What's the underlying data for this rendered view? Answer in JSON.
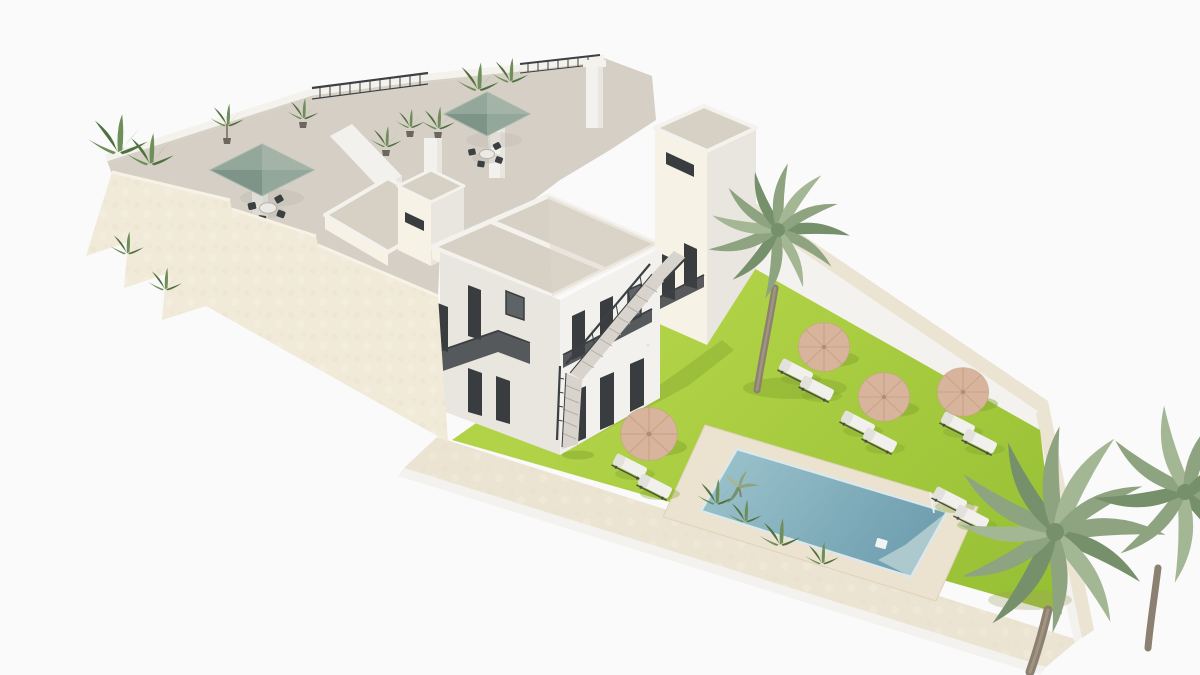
{
  "meta": {
    "kind": "3D architectural exterior render",
    "view": "aerial isometric view on a plain white backdrop",
    "subject": "White Mediterranean-style apartment building with stepped rooftop terraces, exterior staircases, and a walled garden with lawn, rectangular swimming pool, parasols, sun loungers and palm trees"
  },
  "colors": {
    "background": "#fafafa",
    "wall_cream": "#f1ead9",
    "wall_cream_shade": "#e7ddc7",
    "wall_cream_top": "#f7f2e6",
    "facade_white": "#f2f1ed",
    "facade_shade": "#e9e6e0",
    "facade_dark": "#dedad3",
    "roof_tan": "#d7d0c5",
    "terrace_floor": "#d5cfc5",
    "parapet_white": "#f4f2ec",
    "parapet_edge": "#d9d2c4",
    "railing_dark": "#3c4043",
    "window_dark": "#3a3d3f",
    "window_glass": "#5d6366",
    "umbrella_sage": "#93a79a",
    "umbrella_sage_shade": "#7e9488",
    "umbrella_sage_light": "#a3b3a5",
    "lawn_light": "#b2d348",
    "lawn_deep": "#96bf33",
    "shadow_green": "#7fa32c",
    "pool_deck": "#ebe2cf",
    "pool_water_light": "#98c0ca",
    "pool_water_deep": "#6d9dae",
    "pool_steps": "#b7d0d4",
    "pool_rim": "#dce8e9",
    "garden_wall_band": "#ece4d2",
    "garden_wall_face": "#f4f2ee",
    "sand_umbrella": "#d8b49c",
    "sand_umbrella_spoke": "#c5a184",
    "lounger_white": "#f1f0ec",
    "lounger_back": "#e2e1db",
    "lounger_frame": "#4a4d46",
    "stair_tread": "#d8d3cc",
    "stair_line": "#b4aea4",
    "palm_green": "#8ea37f",
    "palm_green_light": "#a4b794",
    "palm_green_dark": "#76906c",
    "palm_trunk": "#8b8071",
    "plant_green": "#6f8f5a",
    "plant_green_dark": "#50703f",
    "table_top": "#eceae6",
    "shadow_warm": "#bdb7ac"
  },
  "building": {
    "roof_terraces": 2,
    "terrace_umbrellas": 2,
    "terrace_dining_sets": 2,
    "towers": 3,
    "roof_decks": 3,
    "chimneys": 1,
    "stair_flights": 3,
    "balcony_railings": 4,
    "facade_planters": 2
  },
  "garden": {
    "lawn_parasols": 4,
    "sun_loungers": 10,
    "palm_trees": 3,
    "pool": {
      "shape": "rectangle",
      "ladder": true,
      "skimmer": true,
      "underwater_bench": true
    }
  }
}
